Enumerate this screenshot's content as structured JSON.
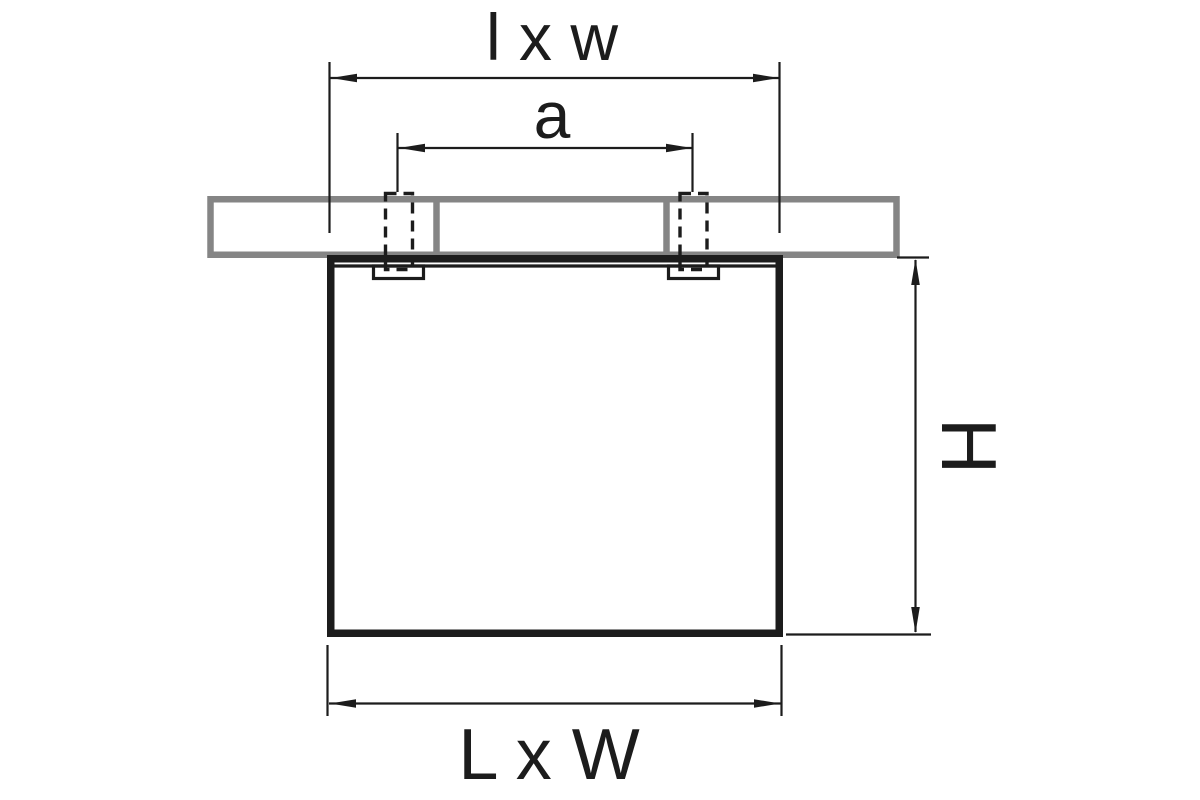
{
  "diagram": {
    "labels": {
      "ceiling_cutout": "l x w",
      "mounting_holes_distance": "a",
      "height": "H",
      "body": "L x W"
    },
    "colors": {
      "line": "#1c1c1c",
      "hatch": "#858585",
      "background": "#ffffff"
    }
  }
}
